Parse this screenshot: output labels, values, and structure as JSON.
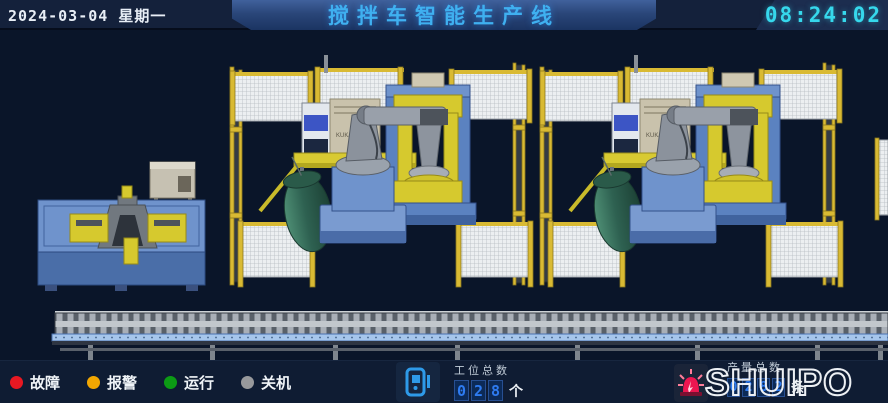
{
  "header": {
    "date": "2024-03-04 星期一",
    "title": "搅拌车智能生产线",
    "time": "08:24:02"
  },
  "scene": {
    "robot_brand": "KUKA",
    "elements": [
      "fixture-station",
      "welding-cell-1",
      "welding-cell-2",
      "safety-fence",
      "mixer-drum-workpiece",
      "robot-positioner",
      "roller-conveyor"
    ]
  },
  "status_legend": {
    "items": [
      {
        "label": "故障",
        "color": "#e81822"
      },
      {
        "label": "报警",
        "color": "#f2a702"
      },
      {
        "label": "运行",
        "color": "#0c9b15"
      },
      {
        "label": "关机",
        "color": "#98999c"
      }
    ]
  },
  "station_counter": {
    "icon": "mobile-device-icon",
    "label": "工位总数",
    "digits": [
      "0",
      "2",
      "8"
    ],
    "unit": "个",
    "digit_color": "#2e7bf0"
  },
  "production_counter": {
    "icon": "alarm-beacon-icon",
    "label": "产量总数",
    "digits": [
      "0",
      "2",
      "8",
      "2"
    ],
    "unit": "条",
    "digit_color": "#2e7bf0"
  },
  "brand": {
    "logo": "SHUIPO"
  },
  "colors": {
    "background": "#0a1529",
    "header_bg": "#14213b",
    "title_text": "#3fb0f0",
    "clock_text": "#36d8ec",
    "fence_yellow": "#d9ba33",
    "machine_blue": "#6f93cc",
    "machine_yellow": "#d6c92e",
    "drum_green": "#2e6151"
  }
}
